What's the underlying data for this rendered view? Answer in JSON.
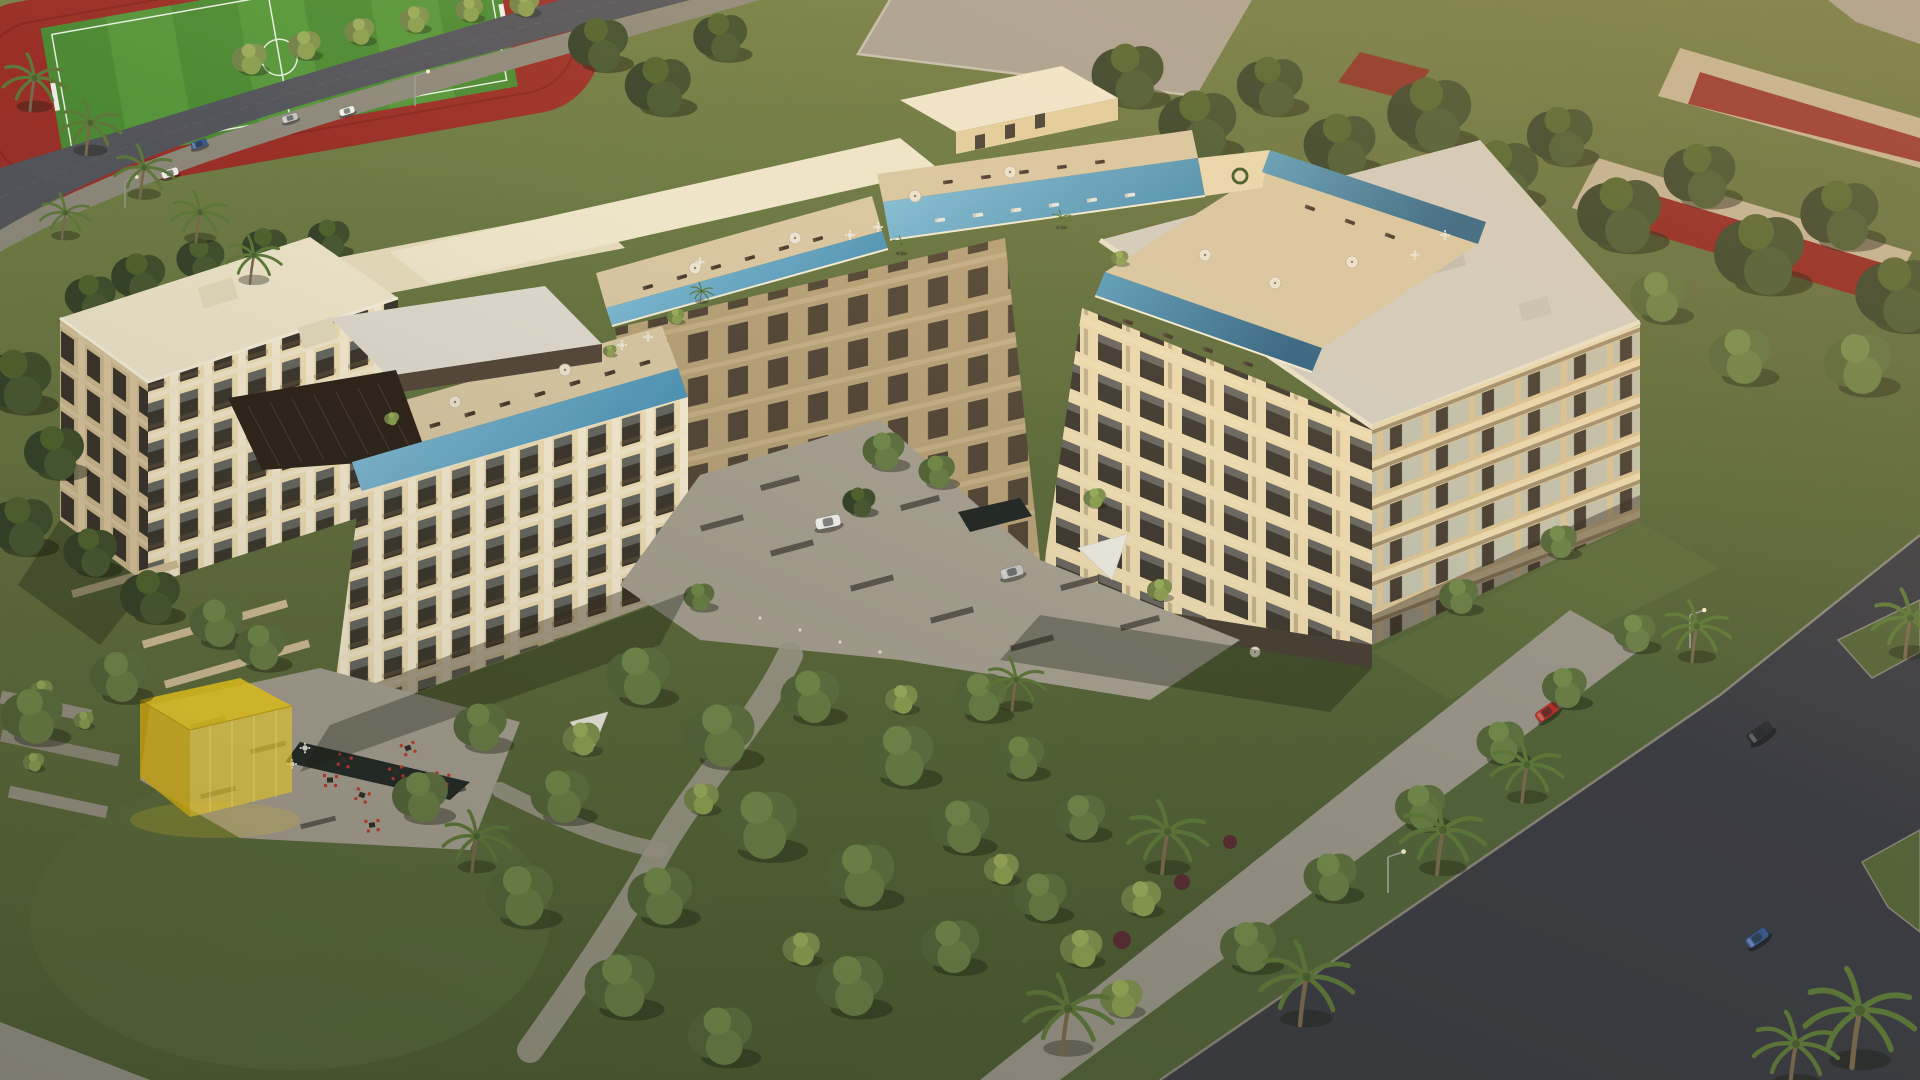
{
  "scene": {
    "type": "aerial-architectural-rendering",
    "subject": "resort-style apartment complex with rooftop infinity pools at golden hour",
    "no_visible_text": true,
    "areas": {
      "northwest": [
        "soccer field with red running track",
        "tree-lined avenue with four parked cars",
        "row of palm trees"
      ],
      "northeast": [
        "walled lots with red courts",
        "dense tree band",
        "neighboring gray rooftops"
      ],
      "complex": [
        "left residential tower with rooftop pergola lounge",
        "front wing with infinity lap pool",
        "back amenity wing with two pool terraces, sun loungers and umbrellas",
        "right residential block with large flat gray roof and pool terrace",
        "ground-floor restaurant terrace"
      ],
      "courtyard": [
        "stone paving with dark paver bands",
        "planted garden beds",
        "white SUV",
        "silver sedan",
        "white shade sail",
        "dark water feature"
      ],
      "southwest": [
        "translucent yellow glass pavilion",
        "cafe terrace with red chairs and dark tables",
        "reflecting pond",
        "planter walls",
        "large lawn with trees",
        "winding footpath",
        "white shade sail"
      ],
      "southeast": [
        "diagonal asphalt street with intersection",
        "green verge with palms and street lamps",
        "red car",
        "dark SUV",
        "blue mini car"
      ]
    },
    "counts": {
      "rooftop_pool_segments": 5,
      "cars_total": 9,
      "street_lamps": 4,
      "umbrella_parasols": 12
    },
    "vehicles": [
      {
        "location": "nw-street",
        "color": "white"
      },
      {
        "location": "nw-street",
        "color": "blue"
      },
      {
        "location": "nw-street",
        "color": "silver"
      },
      {
        "location": "nw-street",
        "color": "white"
      },
      {
        "location": "courtyard",
        "color": "white",
        "kind": "suv"
      },
      {
        "location": "courtyard",
        "color": "silver",
        "kind": "sedan"
      },
      {
        "location": "se-street",
        "color": "red"
      },
      {
        "location": "se-street",
        "color": "dark-gray",
        "kind": "suv"
      },
      {
        "location": "se-street",
        "color": "blue",
        "kind": "mini"
      }
    ]
  },
  "palette": {
    "grassLight": "#7a8749",
    "grass": "#64713f",
    "grassDark": "#4f6035",
    "treeDark": "#3c4a29",
    "treeMid": "#55663a",
    "treeLight": "#76874a",
    "roadNW": "#55565c",
    "roadSE": "#3d3e44",
    "sidewalk": "#9a9588",
    "plaza": "#a8a192",
    "paverDark": "#514c44",
    "track": "#9c3129",
    "field": "#4e8c35",
    "fieldStripe": "#58983c",
    "redCourt": "#8e2520",
    "wallTan": "#c0b194",
    "roofCream": "#efe6cb",
    "roofGray": "#d2ccbe",
    "wallLit": "#f0dfb5",
    "wallShade": "#cdb78e",
    "wallInner": "#b7a178",
    "pier": "#f6ecd2",
    "slab": "#f4e8cc",
    "winDark": "#3e382e",
    "deck": "#d9c7a2",
    "pergola": "#2f251b",
    "poolLight": "#8cc3da",
    "poolDeep": "#4e93b4",
    "poolDark": "#3c7697",
    "yellowCube": "#e8c21e",
    "cafeRed": "#c4372b",
    "carWhite": "#f2f1ec",
    "carSilver": "#c6c6c3",
    "carBlue": "#3a5d8f",
    "carRed": "#b8302a",
    "carDark": "#2e3134"
  }
}
